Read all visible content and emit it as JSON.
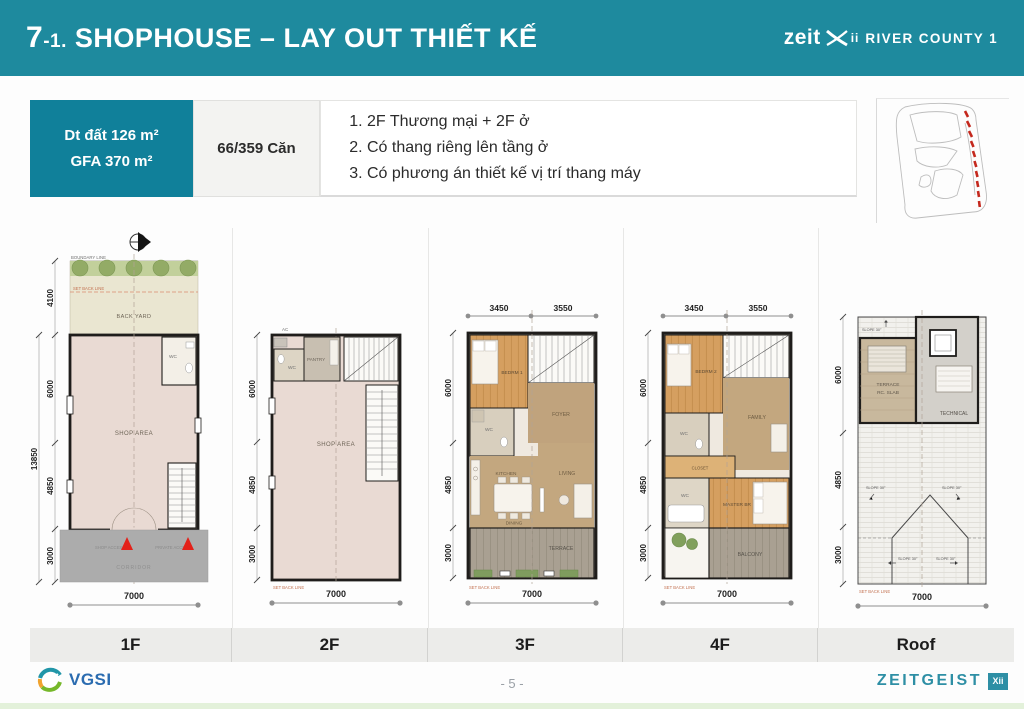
{
  "header": {
    "num": "7",
    "sub": "-1.",
    "title": "SHOPHOUSE – LAY OUT THIẾT KẾ",
    "brand": {
      "pre": "zeit",
      "x_small": "ii",
      "suffix": "RIVER COUNTY 1"
    }
  },
  "info": {
    "area1": "Dt đất 126 m²",
    "area2": "GFA 370 m²",
    "units_count": "66/359 Căn",
    "notes": [
      "2F Thương mại + 2F ở",
      "Có thang riêng lên tầng ở",
      "Có phương án thiết kế vị trí thang máy"
    ]
  },
  "plans": {
    "f1": {
      "tab": "1F",
      "boundary_line": "BOUNDARY LINE",
      "setback_line": "SET BACK LINE",
      "rooms": {
        "backyard": "BACK YARD",
        "wc": "WC",
        "shop": "SHOP AREA",
        "shop_access": "SHOP ACCESS",
        "private_access": "PRIVATE ACCESS",
        "corridor": "CORRIDOR"
      },
      "dims": {
        "total": "13850",
        "left": [
          "4100",
          "6000",
          "4850",
          "3000"
        ],
        "bottom": "7000"
      }
    },
    "f2": {
      "tab": "2F",
      "setback_line": "SET BACK LINE",
      "rooms": {
        "ac": "AC",
        "wc": "WC",
        "pantry": "PANTRY",
        "shop": "SHOP AREA"
      },
      "dims": {
        "left": [
          "6000",
          "4850",
          "3000"
        ],
        "bottom": "7000"
      }
    },
    "f3": {
      "tab": "3F",
      "setback_line": "SET BACK LINE",
      "rooms": {
        "bedroom": "BEDRM 1",
        "wc": "WC",
        "foyer": "FOYER",
        "kitchen": "KITCHEN",
        "dining": "DINING",
        "living": "LIVING",
        "terrace": "TERRACE"
      },
      "dims": {
        "top": [
          "3450",
          "3550"
        ],
        "left": [
          "6000",
          "4850",
          "3000"
        ],
        "bottom": "7000"
      }
    },
    "f4": {
      "tab": "4F",
      "setback_line": "SET BACK LINE",
      "rooms": {
        "bedroom": "BEDRM 2",
        "family": "FAMILY",
        "wc_upper": "WC",
        "closet": "CLOSET",
        "master": "MASTER BR",
        "wc_lower": "WC",
        "balcony": "BALCONY"
      },
      "dims": {
        "top": [
          "3450",
          "3550"
        ],
        "left": [
          "6000",
          "4850",
          "3000"
        ],
        "bottom": "7000"
      }
    },
    "roof": {
      "tab": "Roof",
      "setback_line": "SET BACK LINE",
      "slope": "SLOPE 30°",
      "rooms": {
        "terrace": "TERRACE",
        "slab": "RC. SLAB",
        "technical": "TECHNICAL"
      },
      "dims": {
        "left": [
          "6000",
          "4850",
          "3000"
        ],
        "bottom": "7000"
      }
    }
  },
  "footer": {
    "page": "- 5 -",
    "vgsi": "VGSI",
    "zeitgeist": "ZEITGEIST",
    "badge": "Xii"
  },
  "colors": {
    "header_teal": "#1e8a9e",
    "info_teal": "#10809a",
    "access_red": "#e32119",
    "wood": "#d59f60",
    "tan": "#c3a77f",
    "shop_pink": "#e9dad3"
  }
}
